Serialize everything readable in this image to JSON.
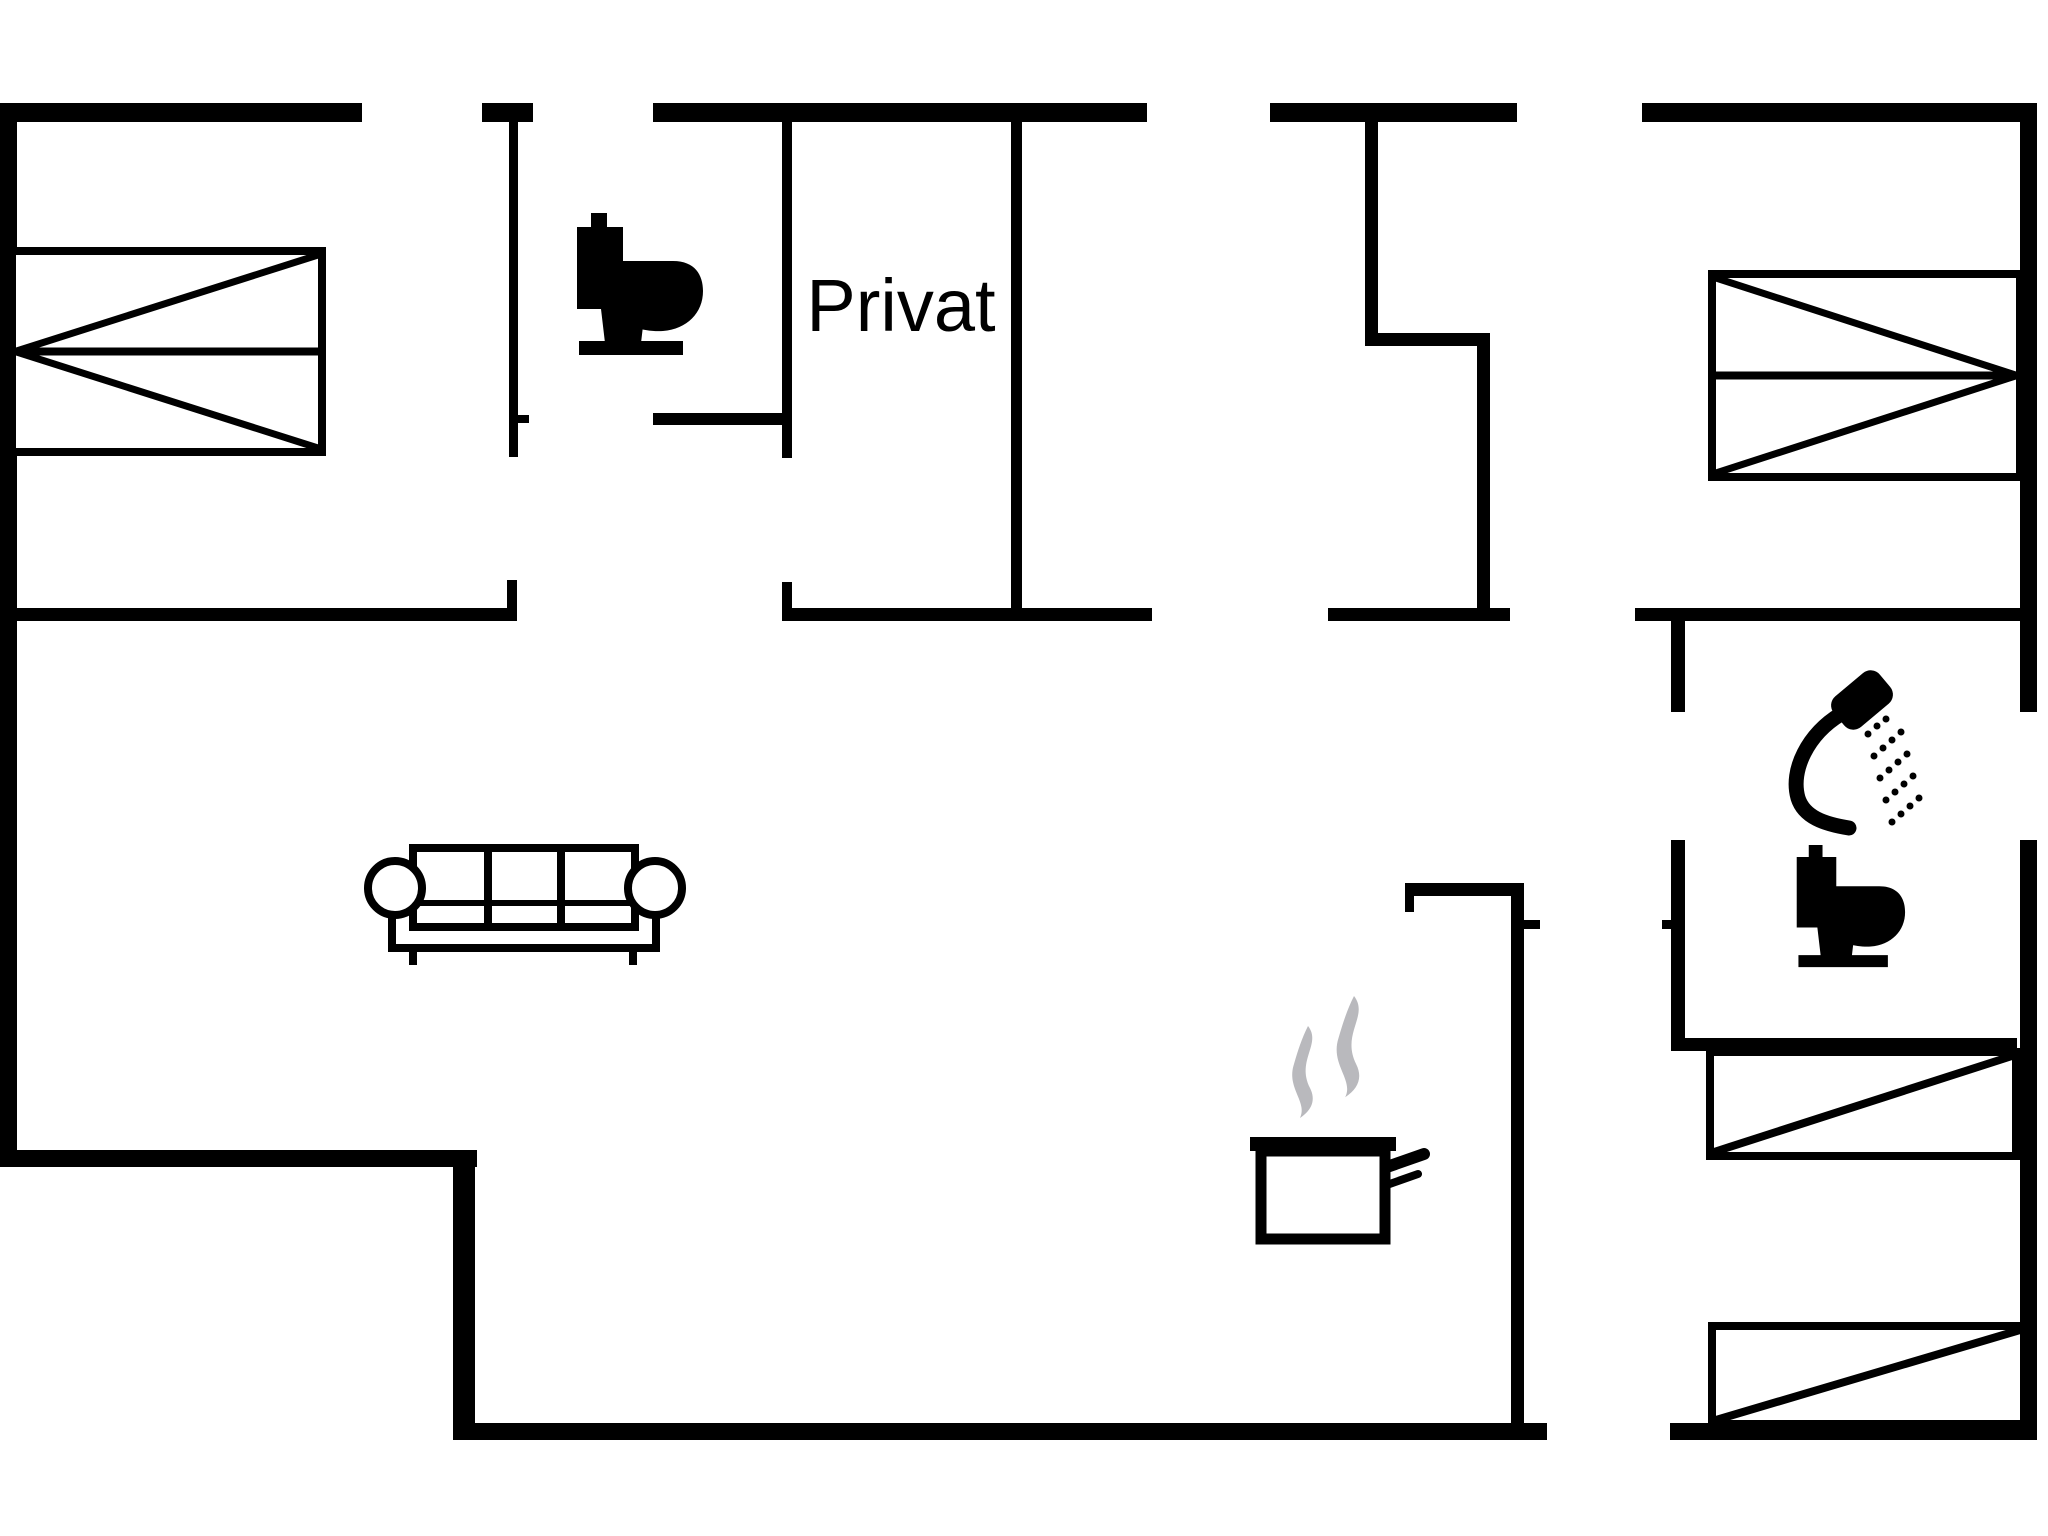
{
  "canvas": {
    "width": 2048,
    "height": 1536
  },
  "colors": {
    "background": "#ffffff",
    "walls": "#000000",
    "furniture": "#000000",
    "steam": "#b9b9bd"
  },
  "room_label": {
    "text": "Privat",
    "x": 901,
    "y": 331,
    "font_size": 74
  },
  "walls": [
    {
      "name": "top-wall-seg-1",
      "x": 0,
      "y": 103,
      "w": 362,
      "h": 19
    },
    {
      "name": "top-wall-cap",
      "x": 482,
      "y": 103,
      "w": 51,
      "h": 19
    },
    {
      "name": "top-wall-seg-2",
      "x": 653,
      "y": 103,
      "w": 494,
      "h": 19
    },
    {
      "name": "top-wall-seg-3",
      "x": 1270,
      "y": 103,
      "w": 247,
      "h": 19
    },
    {
      "name": "top-wall-seg-4",
      "x": 1642,
      "y": 103,
      "w": 395,
      "h": 19
    },
    {
      "name": "left-wall",
      "x": 0,
      "y": 103,
      "w": 17,
      "h": 1064
    },
    {
      "name": "right-wall-upper",
      "x": 2020,
      "y": 103,
      "w": 17,
      "h": 609
    },
    {
      "name": "right-wall-lower",
      "x": 2020,
      "y": 840,
      "w": 17,
      "h": 600
    },
    {
      "name": "bottom-left-step-horizontal",
      "x": 0,
      "y": 1150,
      "w": 477,
      "h": 17
    },
    {
      "name": "bottom-left-step-vertical",
      "x": 453,
      "y": 1150,
      "w": 22,
      "h": 290
    },
    {
      "name": "bottom-wall-seg-1",
      "x": 453,
      "y": 1423,
      "w": 1094,
      "h": 17
    },
    {
      "name": "bottom-wall-seg-2",
      "x": 1670,
      "y": 1423,
      "w": 367,
      "h": 17
    },
    {
      "name": "wc-left-wall",
      "x": 509,
      "y": 118,
      "w": 9,
      "h": 339
    },
    {
      "name": "wc-left-wall-stub",
      "x": 507,
      "y": 580,
      "w": 10,
      "h": 38
    },
    {
      "name": "wc-bottom-wall",
      "x": 653,
      "y": 413,
      "w": 134,
      "h": 12
    },
    {
      "name": "privat-left-wall",
      "x": 782,
      "y": 122,
      "w": 10,
      "h": 336
    },
    {
      "name": "privat-left-wall-stub",
      "x": 782,
      "y": 582,
      "w": 10,
      "h": 36
    },
    {
      "name": "privat-right-wall",
      "x": 1011,
      "y": 122,
      "w": 11,
      "h": 499
    },
    {
      "name": "mid-wall-seg-a",
      "x": 0,
      "y": 608,
      "w": 517,
      "h": 13
    },
    {
      "name": "mid-wall-seg-b",
      "x": 782,
      "y": 608,
      "w": 370,
      "h": 13
    },
    {
      "name": "mid-wall-seg-c",
      "x": 1328,
      "y": 608,
      "w": 182,
      "h": 13
    },
    {
      "name": "mid-wall-seg-d",
      "x": 1635,
      "y": 608,
      "w": 390,
      "h": 13
    },
    {
      "name": "stair-wall-vertical-1",
      "x": 1365,
      "y": 122,
      "w": 13,
      "h": 216
    },
    {
      "name": "stair-wall-horizontal",
      "x": 1365,
      "y": 333,
      "w": 119,
      "h": 13
    },
    {
      "name": "stair-wall-vertical-2",
      "x": 1477,
      "y": 333,
      "w": 13,
      "h": 288
    },
    {
      "name": "bath-left-wall-upper",
      "x": 1671,
      "y": 621,
      "w": 14,
      "h": 91
    },
    {
      "name": "bath-left-wall-lower",
      "x": 1671,
      "y": 840,
      "w": 14,
      "h": 203
    },
    {
      "name": "bath-bottom-wall",
      "x": 1671,
      "y": 1038,
      "w": 346,
      "h": 13
    },
    {
      "name": "kitchen-wall-horizontal",
      "x": 1405,
      "y": 883,
      "w": 119,
      "h": 13
    },
    {
      "name": "kitchen-wall-stub",
      "x": 1405,
      "y": 896,
      "w": 9,
      "h": 16
    },
    {
      "name": "kitchen-wall-vertical",
      "x": 1511,
      "y": 883,
      "w": 13,
      "h": 540
    }
  ],
  "door_ticks": [
    {
      "name": "door-tick-wc",
      "x": 513,
      "y": 415,
      "w": 16,
      "h": 8
    },
    {
      "name": "door-tick-kitchen",
      "x": 1524,
      "y": 920,
      "w": 16,
      "h": 9
    },
    {
      "name": "door-tick-bath",
      "x": 1662,
      "y": 920,
      "w": 16,
      "h": 9
    }
  ],
  "beds": [
    {
      "name": "double-bed-top-left",
      "x": 12,
      "y": 251,
      "w": 310,
      "h": 201,
      "style": "apex-left"
    },
    {
      "name": "double-bed-top-right",
      "x": 1712,
      "y": 274,
      "w": 308,
      "h": 203,
      "style": "apex-right"
    },
    {
      "name": "single-bed-bottom-right-upper",
      "x": 1710,
      "y": 1052,
      "w": 306,
      "h": 104,
      "style": "diagonal"
    },
    {
      "name": "single-bed-bottom-right-lower",
      "x": 1712,
      "y": 1326,
      "w": 312,
      "h": 98,
      "style": "diagonal"
    }
  ],
  "sofa": {
    "seat": {
      "x": 392,
      "y": 872,
      "w": 264,
      "h": 76
    },
    "back": {
      "x": 413,
      "y": 848,
      "w": 222,
      "h": 79
    },
    "band_y": 903,
    "dividers_x": [
      488,
      561
    ],
    "armrests": [
      {
        "cx": 395,
        "cy": 888,
        "r": 27
      },
      {
        "cx": 655,
        "cy": 888,
        "r": 27
      }
    ],
    "legs": [
      {
        "x": 413,
        "y1": 948,
        "y2": 965
      },
      {
        "x": 633,
        "y1": 948,
        "y2": 965
      }
    ],
    "stroke": 8
  },
  "toilet_path": "M16,0 h16 v16 h-16 Z M2,14 h46 v82 h-46 Z M48,48 L98,48 C120,48 128,62 128,78 C128,100 112,116 88,118 C72,119 56,114 48,110 Z M26,96 h44 l-4,34 h-36 Z M4,128 h104 v14 h-104 Z",
  "toilets": [
    {
      "name": "toilet-icon-wc",
      "x": 575,
      "y": 213,
      "scale": 1.0
    },
    {
      "name": "toilet-icon-bath",
      "x": 1795,
      "y": 845,
      "scale": 0.86
    }
  ],
  "shower": {
    "head": {
      "cx": 1862,
      "cy": 700,
      "w": 60,
      "h": 40,
      "rx": 12,
      "angle": -40
    },
    "handle_path": "M1841,714 C1808,734 1790,770 1798,798 C1804,817 1824,824 1849,828",
    "handle_stroke": 15,
    "dots": [
      [
        1868,
        734
      ],
      [
        1877,
        726
      ],
      [
        1886,
        719
      ],
      [
        1874,
        756
      ],
      [
        1883,
        748
      ],
      [
        1892,
        740
      ],
      [
        1901,
        732
      ],
      [
        1880,
        778
      ],
      [
        1889,
        770
      ],
      [
        1898,
        762
      ],
      [
        1907,
        754
      ],
      [
        1886,
        800
      ],
      [
        1895,
        792
      ],
      [
        1904,
        784
      ],
      [
        1913,
        776
      ],
      [
        1892,
        822
      ],
      [
        1901,
        814
      ],
      [
        1910,
        806
      ],
      [
        1919,
        798
      ]
    ],
    "dot_r": 3.5
  },
  "pot": {
    "rim": {
      "x": 1250,
      "y": 1137,
      "w": 146,
      "h": 14
    },
    "body": {
      "x": 1261,
      "y": 1151,
      "w": 124,
      "h": 88,
      "stroke": 11
    },
    "handle": [
      {
        "x1": 1384,
        "y1": 1168,
        "x2": 1424,
        "y2": 1154,
        "stroke": 12
      },
      {
        "x1": 1384,
        "y1": 1186,
        "x2": 1418,
        "y2": 1174,
        "stroke": 8
      }
    ]
  },
  "steam_path": "M20,0 C34,18 8,34 22,62 C28,74 24,84 12,92 C20,76 -2,62 6,38 C10,24 14,12 20,0 Z",
  "steam_wisps": [
    {
      "name": "steam-wisp-left",
      "tx": 1288,
      "ty": 1026,
      "scale": 1.0
    },
    {
      "name": "steam-wisp-right",
      "tx": 1332,
      "ty": 996,
      "scale": 1.1
    }
  ]
}
